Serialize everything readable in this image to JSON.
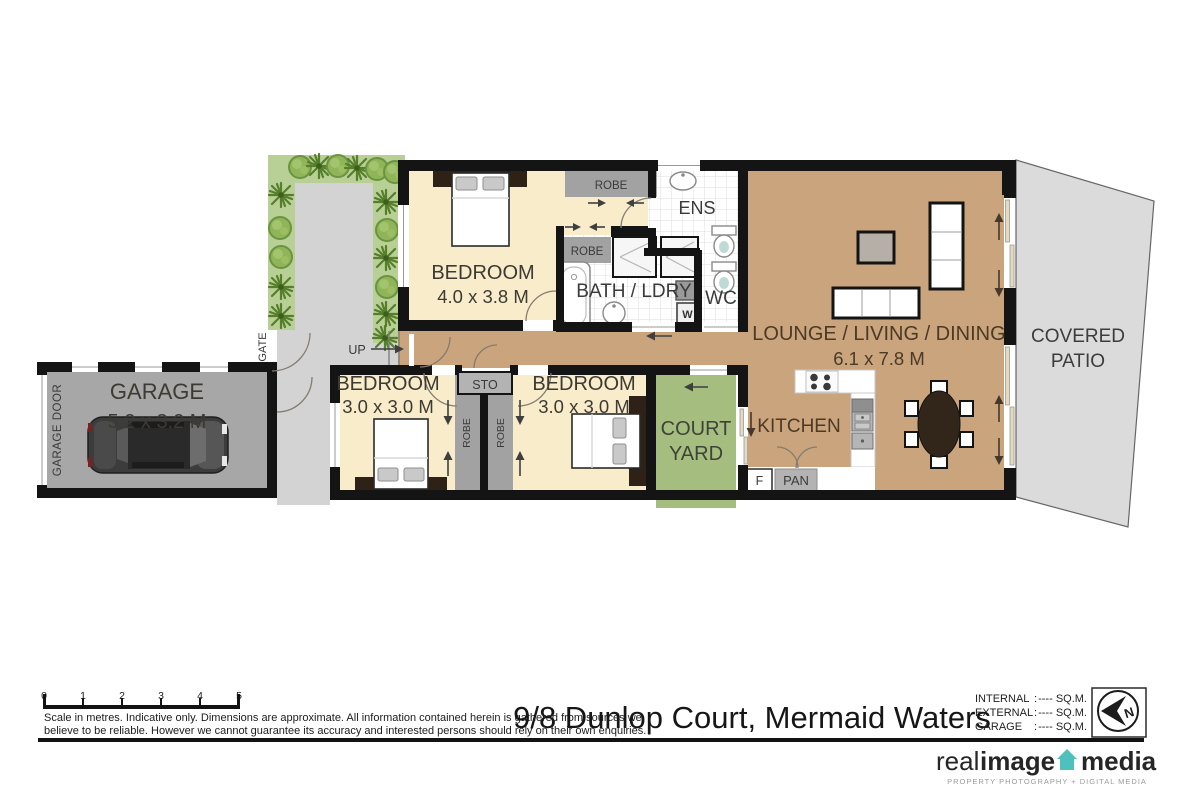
{
  "meta": {
    "address": "9/8 Dunlop Court, Mermaid Waters"
  },
  "rooms": {
    "garage": {
      "name": "GARAGE",
      "dims": "5.2 x 3.2 M"
    },
    "bedroom1": {
      "name": "BEDROOM",
      "dims": "4.0 x 3.8 M"
    },
    "bedroom2": {
      "name": "BEDROOM",
      "dims": "3.0 x 3.0 M"
    },
    "bedroom3": {
      "name": "BEDROOM",
      "dims": "3.0 x 3.0 M"
    },
    "lounge": {
      "name": "LOUNGE / LIVING / DINING",
      "dims": "6.1 x 7.8 M"
    },
    "kitchen": {
      "name": "KITCHEN"
    },
    "courtyard": {
      "l1": "COURT",
      "l2": "YARD"
    },
    "patio": {
      "l1": "COVERED",
      "l2": "PATIO"
    },
    "ens": {
      "name": "ENS"
    },
    "bath": {
      "name": "BATH / LDRY"
    },
    "wc": {
      "name": "WC"
    }
  },
  "fixtures": {
    "robe": "ROBE",
    "sto": "STO",
    "pan": "PAN",
    "fridge": "F",
    "washer": "W",
    "up": "UP",
    "gate": "GATE",
    "garage_door": "GARAGE DOOR"
  },
  "scale_bar": {
    "ticks": [
      "0",
      "1",
      "2",
      "3",
      "4",
      "5"
    ]
  },
  "disclaimer": {
    "line1": "Scale in metres.  Indicative only.  Dimensions are approximate.  All information contained herein is gathered from sources we",
    "line2": "believe to be reliable.  However we cannot guarantee its accuracy and interested persons should rely on their own enquiries."
  },
  "legend": {
    "sep": ":",
    "rows": [
      {
        "label": "INTERNAL",
        "value": "---- SQ.M."
      },
      {
        "label": "EXTERNAL",
        "value": "---- SQ.M."
      },
      {
        "label": "GARAGE",
        "value": "---- SQ.M."
      }
    ]
  },
  "compass": {
    "north": "N"
  },
  "branding": {
    "word1": "real",
    "word2": "image",
    "word3": "media",
    "tagline": "PROPERTY PHOTOGRAPHY + DIGITAL MEDIA",
    "accent": "#4fc1bd"
  },
  "colors": {
    "wall": "#141414",
    "bedroom_floor": "#f8ecca",
    "living_floor": "#c9a47c",
    "courtyard": "#a5bd7f",
    "garden": "#b8cf95",
    "path": "#d3d3d3",
    "garage_floor": "#a7a7a7",
    "patio": "#dbdbdb",
    "logo_teal": "#4fc1bd"
  }
}
